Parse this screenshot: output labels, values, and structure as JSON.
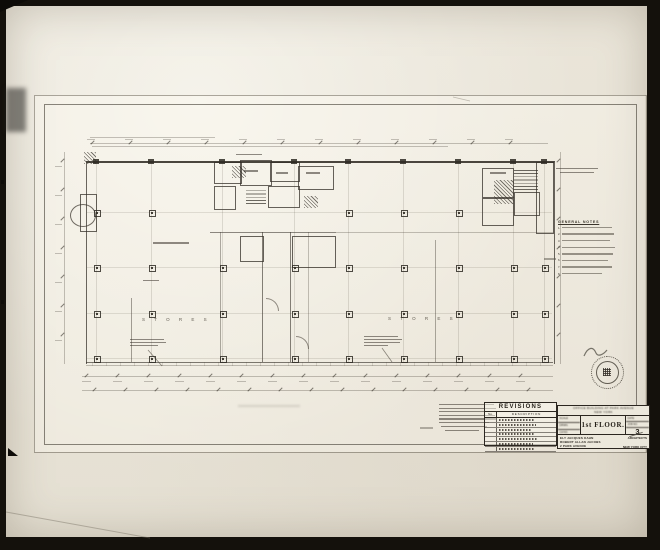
{
  "photo": {
    "kind": "photograph of architectural drawing",
    "sheet": "first floor plan"
  },
  "title_block": {
    "project_line1": "OFFICE BUILDING AT PARK AVENUE",
    "project_line2": "NEW YORK",
    "scale_label": "SCALE",
    "drawn_label": "DRWN.",
    "checked_label": "CH'KD.",
    "date_label": "DATE",
    "job_label": "JOB NO.",
    "sheet_title": "1st FLOOR.",
    "sheet_number": "3",
    "architect_line1": "ELY JACQUES KAHN",
    "architect_line2": "ROBERT ALLAN JACOBS",
    "architect_line3": "2 PARK AVENUE",
    "architects_label": "ARCHITECTS",
    "city_label": "NEW YORK CITY"
  },
  "revisions": {
    "header": "REVISIONS",
    "col_no": "No.",
    "col_desc": "DESCRIPTION",
    "row_count": 7
  },
  "general_notes": {
    "heading": "GENERAL NOTES",
    "item_count": 8
  },
  "plan": {
    "bay_label_left": "S T O R E S",
    "bay_label_right": "S T O R E S",
    "column_grid": {
      "cols": [
        96,
        151,
        222,
        294,
        348,
        403,
        458,
        513,
        544
      ],
      "rows": [
        212,
        267,
        313,
        358
      ],
      "skip_row0_cols": [
        2,
        3,
        7,
        8
      ]
    }
  },
  "stamp": {
    "label": "architect-seal"
  },
  "colors": {
    "paper": "#eae5d9",
    "ink": "#2b2620",
    "frame": "#0d0b08"
  }
}
